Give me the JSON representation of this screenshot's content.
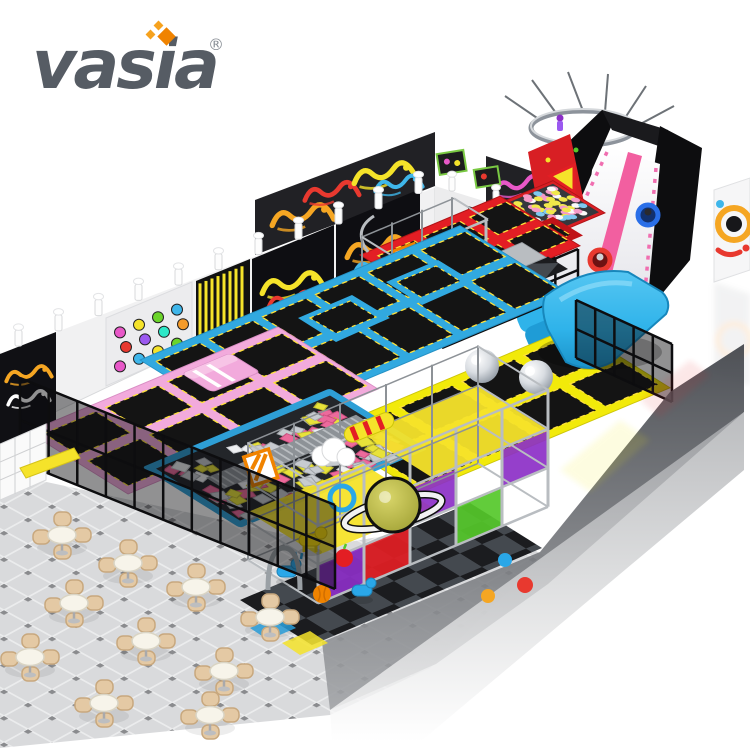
{
  "brand": {
    "logo_text": "vasia",
    "registered_mark": "®"
  },
  "image_subject": {
    "type": "isometric 3d product render",
    "subject": "indoor trampoline park and soft play playground with slides, foam pit, ball pool and cafe seating",
    "background": "white"
  },
  "palette": {
    "logo_gray": "#565c64",
    "logo_orange": "#f08300",
    "logo_orange_light": "#f6a21e",
    "wall": "#f1f1f2",
    "wall_shade": "#d8d9db",
    "panel_black": "#101014",
    "trampoline_red": "#e31e24",
    "trampoline_red_dark": "#b01316",
    "trampoline_blue": "#31a9e0",
    "trampoline_pink": "#f2aadc",
    "trampoline_yellow": "#f2ea0a",
    "mat_black": "#141414",
    "mat_border_yellow": "#ffe23c",
    "steel_gray": "#b9bdc1",
    "steel_gray_dark": "#8d9297",
    "airbag_blue": "#2fb3ea",
    "slide_white": "#f5f5f7",
    "slide_pink": "#f25fa0",
    "foam_pink": "#ec6a9c",
    "foam_yellow": "#e8e23a",
    "foam_gray": "#c7cbd0",
    "foam_white": "#eef0f2",
    "ball_pink": "#f59bc8",
    "ball_yellow": "#f0e84a",
    "ball_white": "#fafafa",
    "ball_blue": "#7ec8f0",
    "saturn_olive": "#b9b945",
    "purple_panel": "#8c2fc7",
    "green_panel": "#55c82a",
    "orange_panel": "#f08300",
    "chair_beige": "#e4c9a4",
    "chair_beige_dark": "#c8a87e",
    "table_white": "#f7f4ea",
    "floor_tile": "#d9dadc",
    "floor_dot": "#8a8b8e",
    "checker_dark": "#1b1c1f",
    "checker_gray": "#44494f",
    "fence_black": "#0d0d0f"
  },
  "dot_panel_colors": [
    "#e858c8",
    "#f5e32a",
    "#6bd42a",
    "#3fb6ea",
    "#e8392f",
    "#9b59f0",
    "#2ee8c8",
    "#f59b2a",
    "#e858c8",
    "#3fb6ea",
    "#f5e32a",
    "#6bd42a"
  ],
  "graffiti_colors": [
    "#f5a623",
    "#e8392f",
    "#3fb6ea",
    "#f5e32a",
    "#ffffff",
    "#e858c8"
  ],
  "zones": [
    {
      "id": "red-trampoline-zone",
      "name": "red trampoline court with ball pool"
    },
    {
      "id": "blue-trampoline-zone",
      "name": "blue trampoline court with banked wall trampolines"
    },
    {
      "id": "pink-trampoline-zone",
      "name": "pink trampoline court with vault block"
    },
    {
      "id": "yellow-trampoline-zone",
      "name": "yellow trampoline court with inflatable balls"
    },
    {
      "id": "foam-pit",
      "name": "foam cube pit with balance beam"
    },
    {
      "id": "donut-slide",
      "name": "black tower donut slide with pink stripe and air bag landing"
    },
    {
      "id": "soft-play-structure",
      "name": "steel frame soft play structure with saturn decoration"
    },
    {
      "id": "cafe-area",
      "name": "cafe seating with beige chairs and round tables"
    }
  ]
}
